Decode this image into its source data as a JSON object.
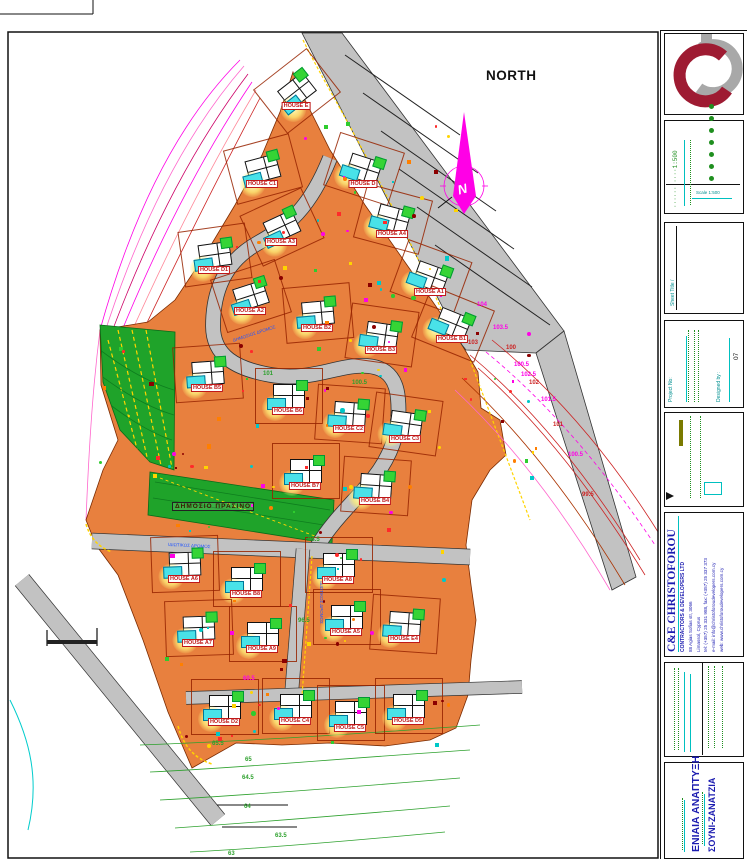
{
  "north_label": "NORTH",
  "map": {
    "green_area_label": "ΔΗΜΟΣΙΟ ΠΡΑΣΙΝΟ",
    "road_labels": [
      {
        "t": "ΔΗΜΟΣΙΟΣ ΔΡΟΜΟΣ",
        "x": 232,
        "y": 331,
        "rot": -18
      },
      {
        "t": "ΙΔΙΩΤΙΚΟΣ ΔΡΟΜΟΣ",
        "x": 168,
        "y": 543,
        "rot": 3
      },
      {
        "t": "ΙΔΙΩΤΙΚΟΣ ΔΡΟΜΟΣ",
        "x": 300,
        "y": 600,
        "rot": 90
      }
    ],
    "houses": [
      {
        "label": "HOUSE E",
        "x": 296,
        "y": 90,
        "rot": -38
      },
      {
        "label": "HOUSE C1",
        "x": 262,
        "y": 168,
        "rot": -15
      },
      {
        "label": "HOUSE D",
        "x": 363,
        "y": 168,
        "rot": 18
      },
      {
        "label": "HOUSE A3",
        "x": 281,
        "y": 226,
        "rot": -25
      },
      {
        "label": "HOUSE D1",
        "x": 214,
        "y": 254,
        "rot": -8
      },
      {
        "label": "HOUSE A4",
        "x": 392,
        "y": 218,
        "rot": 15
      },
      {
        "label": "HOUSE A1",
        "x": 430,
        "y": 276,
        "rot": 20
      },
      {
        "label": "HOUSE A2",
        "x": 250,
        "y": 295,
        "rot": -18
      },
      {
        "label": "HOUSE B2",
        "x": 317,
        "y": 312,
        "rot": -5
      },
      {
        "label": "HOUSE B3",
        "x": 381,
        "y": 334,
        "rot": 8
      },
      {
        "label": "HOUSE B1",
        "x": 452,
        "y": 323,
        "rot": 22
      },
      {
        "label": "HOUSE B5",
        "x": 207,
        "y": 372,
        "rot": -4
      },
      {
        "label": "HOUSE B6",
        "x": 288,
        "y": 395,
        "rot": 0
      },
      {
        "label": "HOUSE C2",
        "x": 349,
        "y": 413,
        "rot": 4
      },
      {
        "label": "HOUSE C3",
        "x": 405,
        "y": 423,
        "rot": 8
      },
      {
        "label": "HOUSE B7",
        "x": 305,
        "y": 470,
        "rot": 0
      },
      {
        "label": "HOUSE B4",
        "x": 375,
        "y": 485,
        "rot": 4
      },
      {
        "label": "HOUSE A6",
        "x": 184,
        "y": 563,
        "rot": -2
      },
      {
        "label": "HOUSE B8",
        "x": 246,
        "y": 578,
        "rot": 0
      },
      {
        "label": "HOUSE A8",
        "x": 338,
        "y": 564,
        "rot": 0
      },
      {
        "label": "HOUSE A7",
        "x": 198,
        "y": 627,
        "rot": -2
      },
      {
        "label": "HOUSE A9",
        "x": 262,
        "y": 633,
        "rot": 0
      },
      {
        "label": "HOUSE A5",
        "x": 346,
        "y": 616,
        "rot": 0
      },
      {
        "label": "HOUSE E4",
        "x": 404,
        "y": 623,
        "rot": 4
      },
      {
        "label": "HOUSE D2",
        "x": 224,
        "y": 706,
        "rot": 0
      },
      {
        "label": "HOUSE C4",
        "x": 295,
        "y": 705,
        "rot": 0
      },
      {
        "label": "HOUSE C5",
        "x": 350,
        "y": 712,
        "rot": 0
      },
      {
        "label": "HOUSE D5",
        "x": 408,
        "y": 705,
        "rot": 0
      }
    ],
    "contour_labels": [
      {
        "t": "104",
        "x": 477,
        "y": 302,
        "c": "#ff00e6"
      },
      {
        "t": "103.5",
        "x": 493,
        "y": 325,
        "c": "#ff00e6"
      },
      {
        "t": "103",
        "x": 468,
        "y": 340,
        "c": "#cc2222"
      },
      {
        "t": "100",
        "x": 506,
        "y": 345,
        "c": "#cc2222"
      },
      {
        "t": "100.5",
        "x": 514,
        "y": 362,
        "c": "#ff00e6"
      },
      {
        "t": "102.5",
        "x": 521,
        "y": 372,
        "c": "#ff00e6"
      },
      {
        "t": "102",
        "x": 529,
        "y": 380,
        "c": "#cc2222"
      },
      {
        "t": "101.5",
        "x": 541,
        "y": 397,
        "c": "#ff00e6"
      },
      {
        "t": "101",
        "x": 553,
        "y": 422,
        "c": "#cc2222"
      },
      {
        "t": "100.5",
        "x": 568,
        "y": 452,
        "c": "#ff00e6"
      },
      {
        "t": "99.5",
        "x": 582,
        "y": 492,
        "c": "#cc2222"
      },
      {
        "t": "60.5",
        "x": 243,
        "y": 676,
        "c": "#ff00e6"
      },
      {
        "t": "65",
        "x": 245,
        "y": 757,
        "c": "#2ea12e"
      },
      {
        "t": "64.5",
        "x": 242,
        "y": 775,
        "c": "#2ea12e"
      },
      {
        "t": "64",
        "x": 244,
        "y": 804,
        "c": "#2ea12e"
      },
      {
        "t": "63.5",
        "x": 275,
        "y": 833,
        "c": "#2ea12e"
      },
      {
        "t": "63",
        "x": 228,
        "y": 851,
        "c": "#2ea12e"
      },
      {
        "t": "101",
        "x": 263,
        "y": 371,
        "c": "#2ea12e"
      },
      {
        "t": "100.5",
        "x": 352,
        "y": 380,
        "c": "#2ea12e"
      },
      {
        "t": "98.5",
        "x": 308,
        "y": 537,
        "c": "#2ea12e"
      },
      {
        "t": "96.5",
        "x": 298,
        "y": 618,
        "c": "#2ea12e"
      },
      {
        "t": "65.5",
        "x": 212,
        "y": 741,
        "c": "#2ea12e"
      }
    ]
  },
  "titleblock": {
    "scale_text": "1:500",
    "scale_caption": "Scale 1:500",
    "sheet_title_label": "Sheet Title /",
    "project_no_label": "Project No:",
    "designed_by_label": "Designed by :",
    "designed_by_value": "07",
    "company": {
      "name": "C&E CHRISTOFOROU",
      "subtitle": "CONTRACTORS & DEVELOPERS LTD",
      "address1": "88 Agias Sofias str, 3066",
      "address2": "Limassol, Cyprus",
      "phone": "tel: (+357) 25 331 988, fax: (+357) 25 337 373",
      "email": "e-mail: info@christoforoudevelopers.com.cy",
      "web": "web: www.christoforoudevelopers.com.cy"
    },
    "project_line1": "ΕΝΙΑΙΑ ΑΝΑΠΤΥΞΗ",
    "project_line2": "ΣΟΥΝΙ-ΖΑΝΑΤΖΙΑ"
  },
  "colors": {
    "orange": "#E8803E",
    "road": "#C2C2C2",
    "roadEdge": "#333333",
    "green": "#1FA32A",
    "greenDark": "#0E7D1E",
    "magenta": "#FF00E6",
    "contourRed": "#CC2222",
    "yellow": "#FFD400",
    "cyan": "#00C0C0",
    "labelRed": "#C01818",
    "blue": "#1C1CB0",
    "teal": "#009090",
    "dotGreen": "#1F8F1F",
    "logoGray": "#A8A8A8",
    "logoCrimson": "#9E1B32"
  }
}
